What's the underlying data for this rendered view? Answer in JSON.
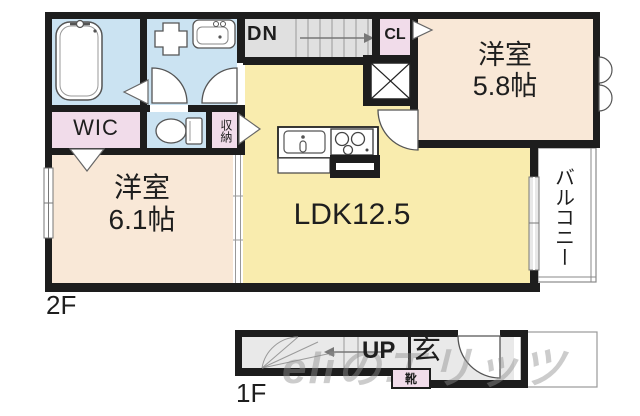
{
  "floor2": {
    "label": "2F",
    "dn_label": "DN",
    "cl_label": "CL",
    "wic_label": "WIC",
    "storage_label": "収納",
    "room_58": {
      "name": "洋室",
      "size": "5.8帖"
    },
    "room_61": {
      "name": "洋室",
      "size": "6.1帖"
    },
    "ldk_label": "LDK12.5",
    "balcony_label": "バルコニー"
  },
  "floor1": {
    "label": "1F",
    "up_label": "UP",
    "entrance_label": "玄",
    "shoes_label": "靴"
  },
  "watermark": {
    "latin": "eli",
    "jp": "のエリッツ"
  },
  "colors": {
    "wet_room": "#cbe3f2",
    "closet": "#f1dcea",
    "bedroom": "#f9e8d7",
    "ldk": "#f9ecae",
    "stairs": "#e0e0e0",
    "genkan_floor": "#e9e9e9",
    "balcony": "#ffffff",
    "wall": "#1d1d1d"
  }
}
